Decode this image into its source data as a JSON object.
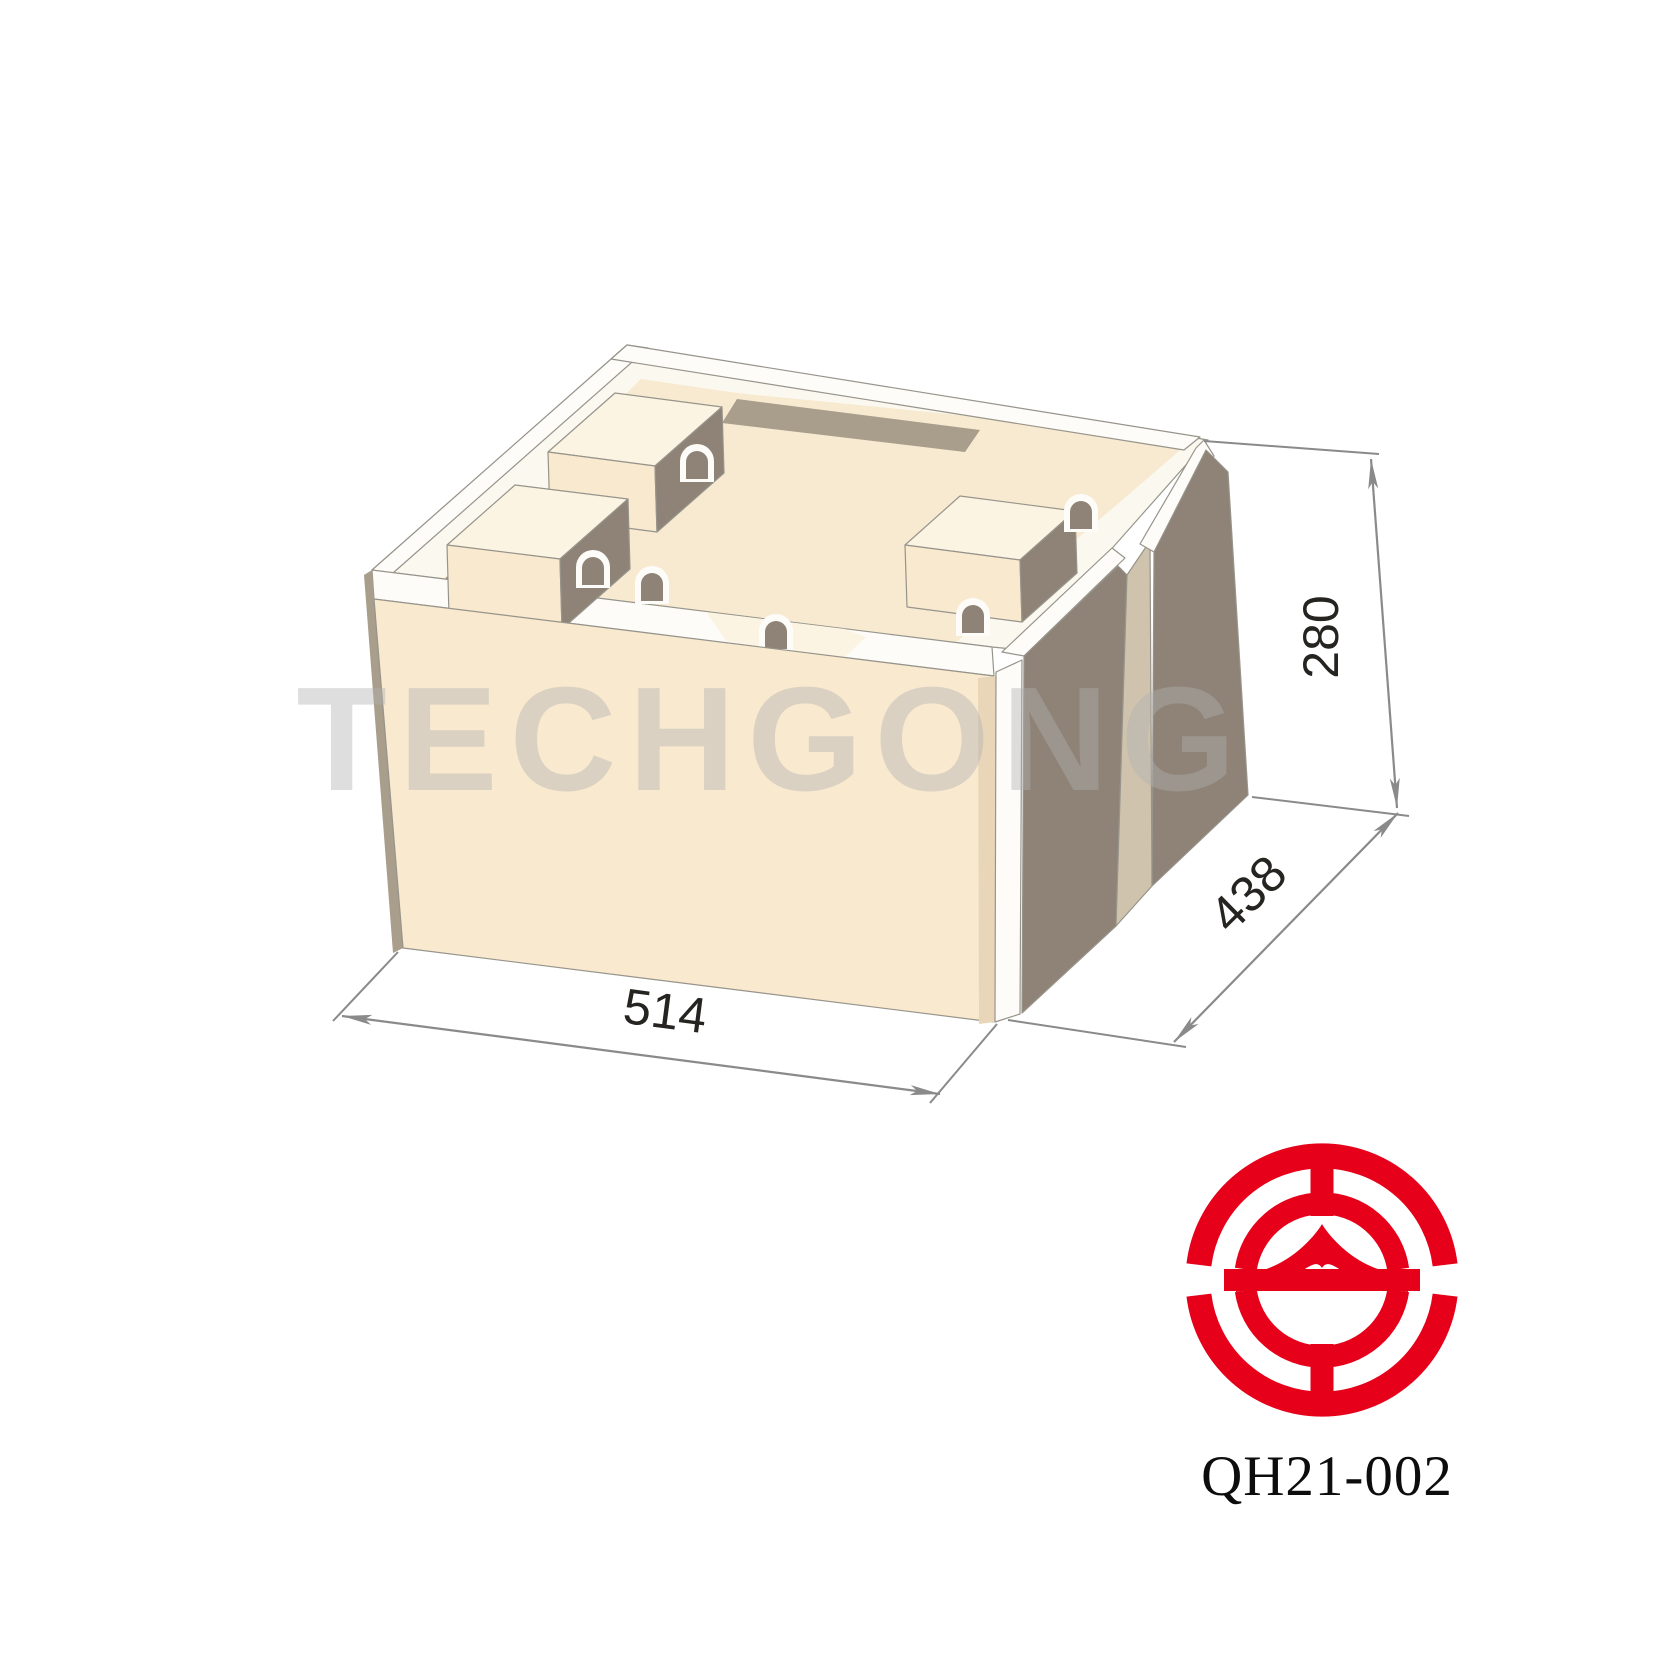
{
  "page": {
    "background": "#ffffff"
  },
  "drawing": {
    "title": "interlocking hollow block isometric technical illustration",
    "dimensions": {
      "length": {
        "value": "514"
      },
      "depth": {
        "value": "438"
      },
      "height": {
        "value": "280"
      }
    },
    "watermark": {
      "text": "TECHGONG",
      "color": "rgba(176,176,176,0.42)"
    },
    "colors": {
      "cream": "#f8e9cf",
      "cream_light": "#fcf4e3",
      "cream_dark": "#e9d6b8",
      "floor": "#f7ead1",
      "white_bevel": "#fdfcf8",
      "top_white": "#fbf8f0",
      "taupe_dark": "#8e8376",
      "taupe_mid": "#a99d8b",
      "taupe_light": "#cfc3ae",
      "outline": "#97948b",
      "dim_line": "#8a8a8a",
      "dim_text": "#262421"
    }
  },
  "branding": {
    "logo": {
      "name": "techgong-logo",
      "color": "#e60019"
    },
    "product_code": "QH21-002"
  }
}
